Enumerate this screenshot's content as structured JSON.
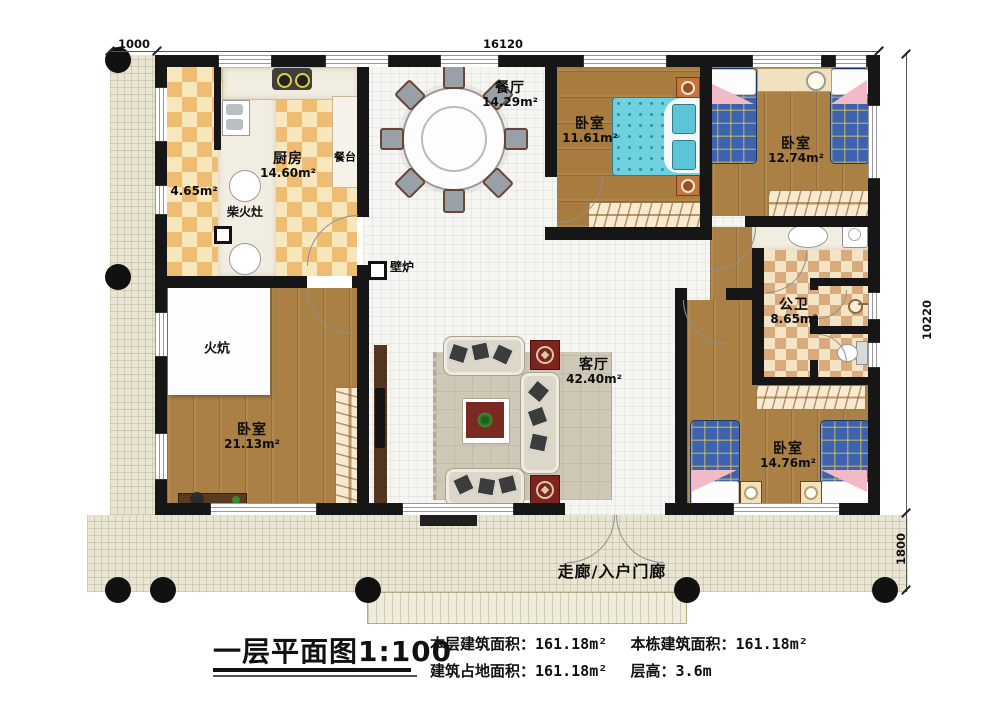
{
  "dims": {
    "porch_width": "1000",
    "total_width": "16120",
    "total_depth": "10220",
    "porch_depth": "1800"
  },
  "rooms": {
    "kitchen": {
      "name": "厨房",
      "area": "14.60m²"
    },
    "counter": {
      "name": "餐台"
    },
    "stove_room": {
      "area": "4.65m²",
      "stove_name": "柴火灶"
    },
    "dining": {
      "name": "餐厅",
      "area": "14.29m²"
    },
    "bedroom_top_mid": {
      "name": "卧室",
      "area": "11.61m²"
    },
    "bedroom_top_right": {
      "name": "卧室",
      "area": "12.74m²"
    },
    "bathroom": {
      "name": "公卫",
      "area": "8.65m²"
    },
    "living": {
      "name": "客厅",
      "area": "42.40m²"
    },
    "bedroom_left": {
      "name": "卧室",
      "area": "21.13m²"
    },
    "bedroom_bottom_right": {
      "name": "卧室",
      "area": "14.76m²"
    },
    "kang": {
      "name": "火炕"
    },
    "fireplace": {
      "name": "壁炉"
    },
    "porch": {
      "name": "走廊/入户门廊"
    }
  },
  "legend": {
    "title": "一层平面图",
    "scale": "1:100"
  },
  "stats": [
    {
      "label": "本层建筑面积：",
      "value": "161.18m²"
    },
    {
      "label": "本栋建筑面积：",
      "value": "161.18m²"
    },
    {
      "label": "建筑占地面积：",
      "value": "161.18m²"
    },
    {
      "label": "层高：",
      "value": "3.6m"
    }
  ]
}
